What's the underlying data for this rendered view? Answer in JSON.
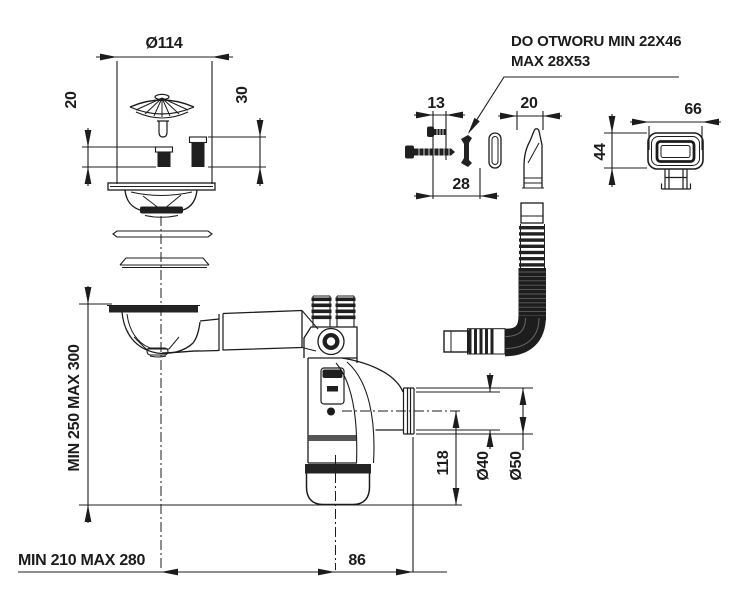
{
  "drawing": {
    "labels": {
      "strainer_diameter": "Ø114",
      "plug_height_small": "20",
      "plug_height_large": "30",
      "hole_note_line1": "DO OTWORU MIN 22X46",
      "hole_note_line2": "MAX 28X53",
      "screw_short_length": "13",
      "overflow_elbow_width": "20",
      "cover_width": "66",
      "cover_height": "44",
      "screw_long_length": "28",
      "install_height_range": "MIN 250 MAX 300",
      "install_width_range": "MIN 210 MAX 280",
      "outlet_offset": "86",
      "outlet_height": "118",
      "outlet_pipe_diameter": "Ø40",
      "outlet_nut_diameter": "Ø50"
    },
    "colors": {
      "line": "#1c1c1c",
      "dark_fill": "#1f1f1f",
      "background": "#ffffff"
    }
  }
}
